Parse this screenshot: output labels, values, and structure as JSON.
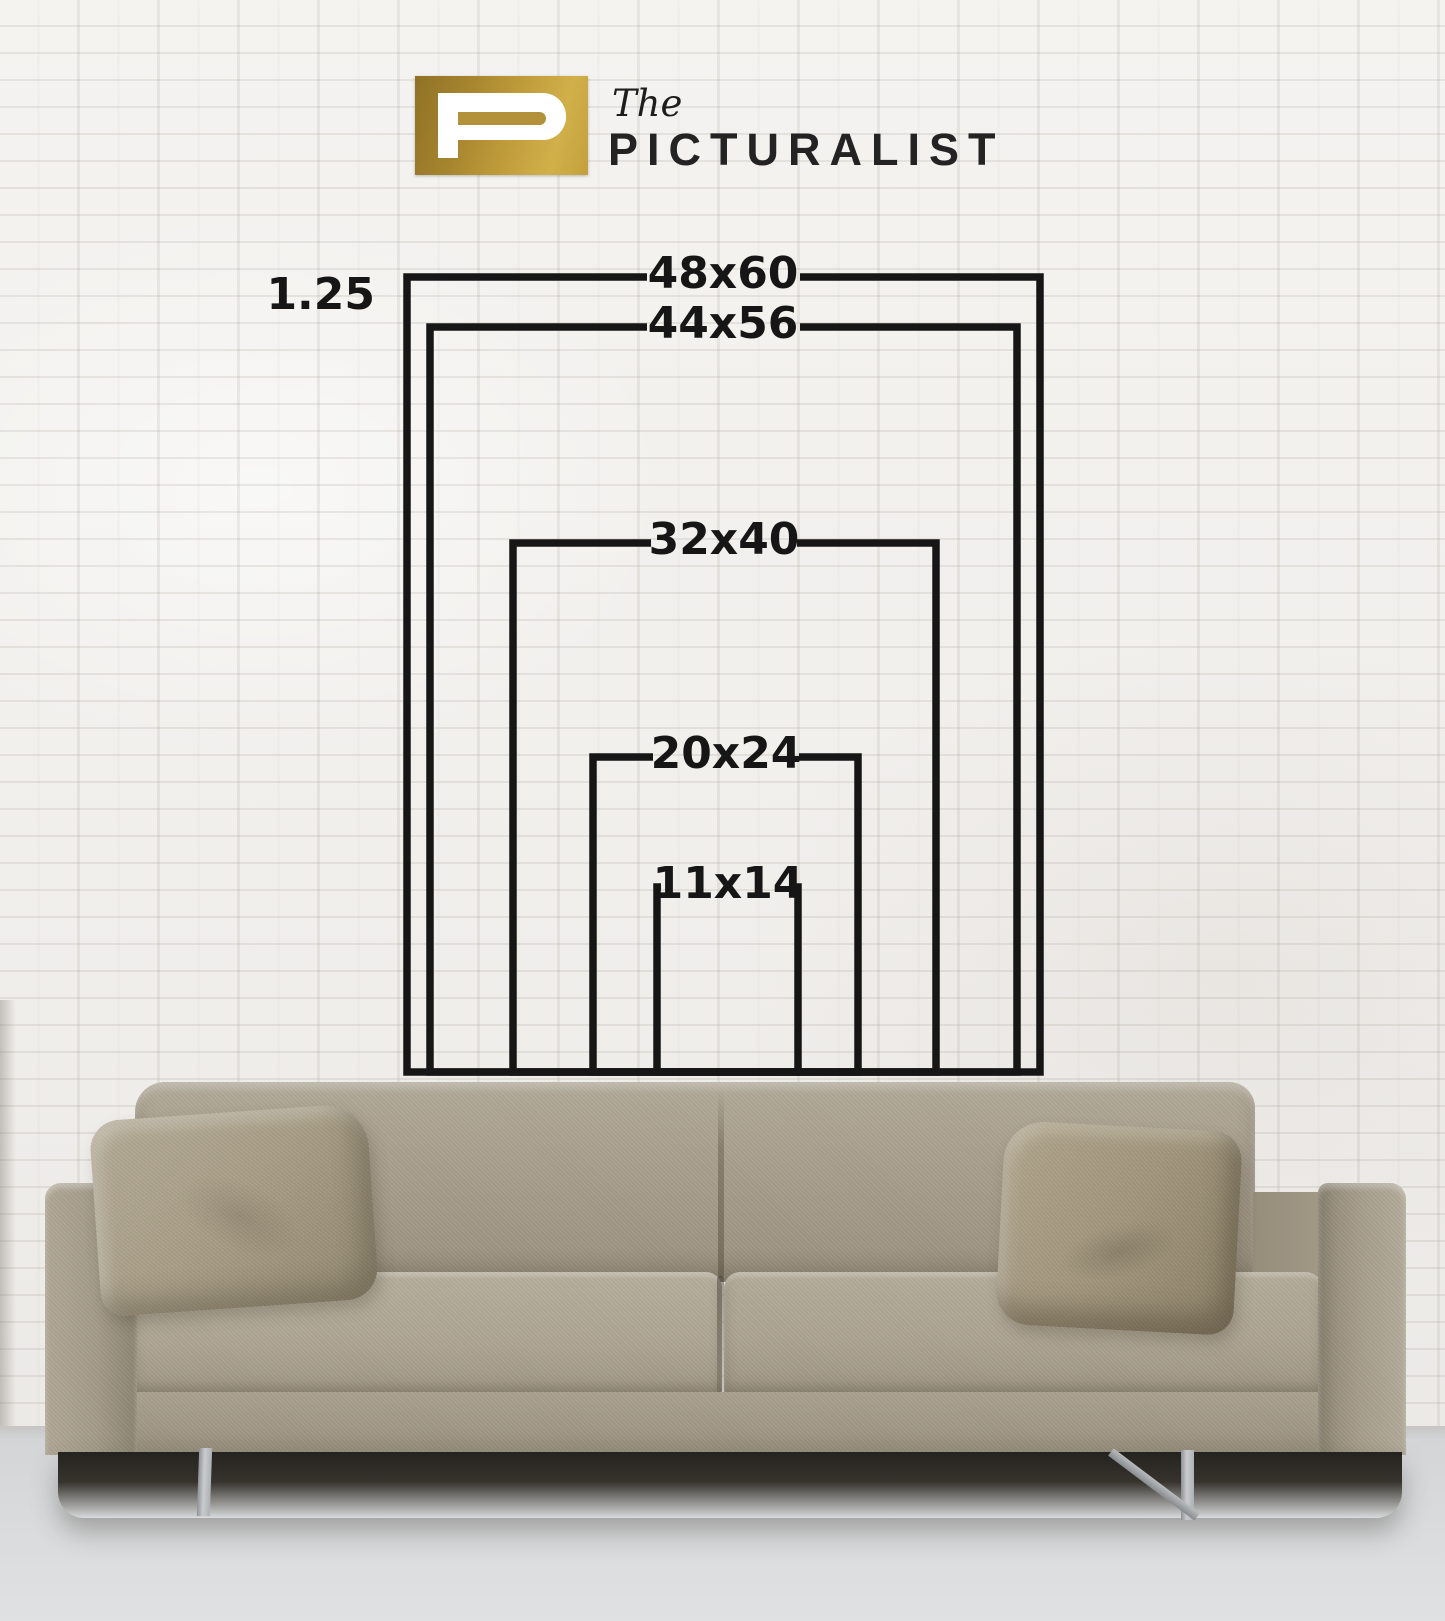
{
  "brand": {
    "the": "The",
    "name": "PICTURALIST",
    "logo_letter": "P",
    "logo_gold": "#b5923a"
  },
  "diagram": {
    "ratio_label": "1.25",
    "line_color": "#161616",
    "sizes": [
      {
        "label": "48x60"
      },
      {
        "label": "44x56"
      },
      {
        "label": "32x40"
      },
      {
        "label": "20x24"
      },
      {
        "label": "11x14"
      }
    ]
  },
  "colors": {
    "wall": "#f1efec",
    "floor": "#d8dadc",
    "sofa_fabric": "#a89f8d",
    "shadow": "#25231f",
    "text": "#161616"
  }
}
